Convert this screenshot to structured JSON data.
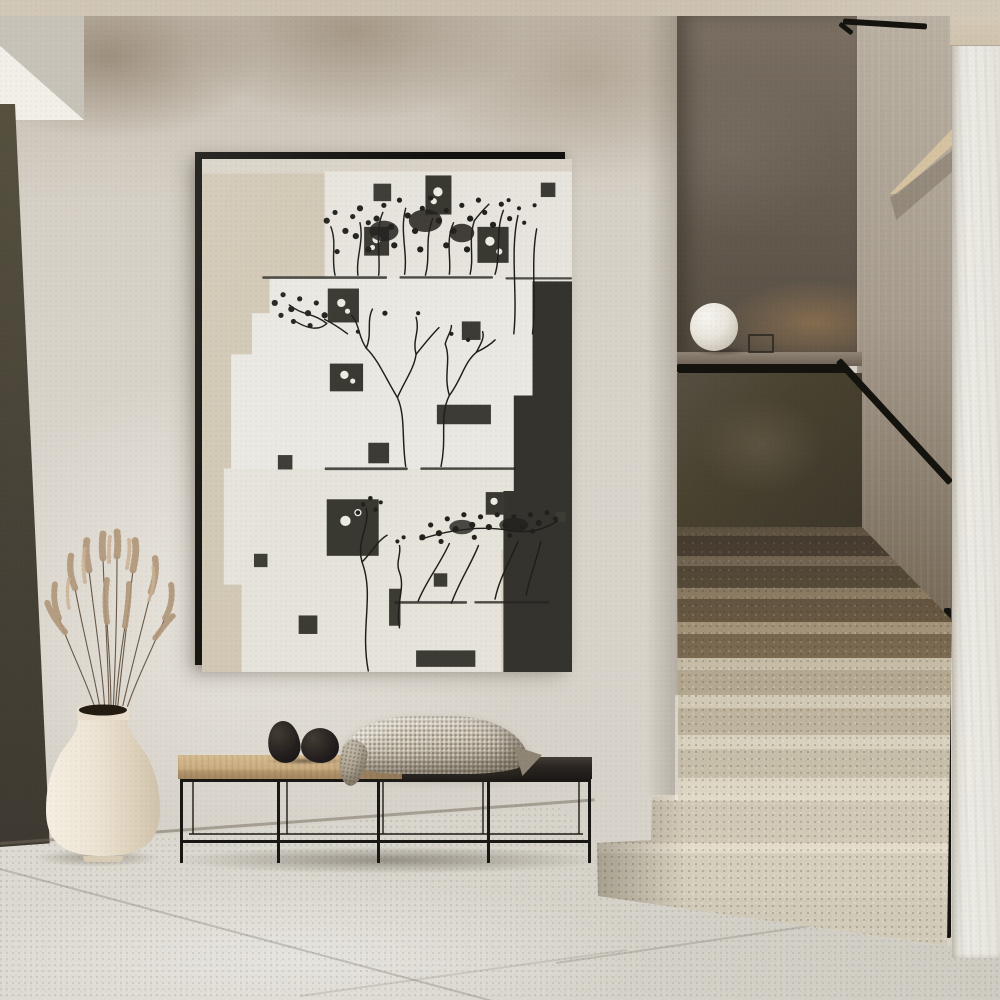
{
  "meta": {
    "title": "Minimalist hallway interior",
    "description": "Photorealistic render of a hallway with a framed black-and-white botanical collage above a slim metal bench, a cream vase with dried grass, and a terrazzo staircase with black handrail and sphere lamp"
  },
  "scene": {
    "artwork": {
      "label": "Framed botanical collage print",
      "frame_color": "#12110e",
      "canvas_base": "#d8d1c2",
      "paper_blocks": [
        "#eae8e2",
        "#e7e4dd",
        "#d1c7b4"
      ],
      "dark_block": "#34332d",
      "branch_color": "#201e1a",
      "photo_square": "#3a3931",
      "bloom_color": "#edebe3"
    },
    "bench": {
      "label": "Slim black metal bench with oak and black top",
      "wood_top": "#ccae82",
      "dark_top": "#2a2521",
      "frame_color": "#1a1815",
      "decor_stones": "two matte black stone spheres",
      "stone_color": "#262120",
      "throw_label": "Waffle knit throw blanket",
      "throw_color": "#c6bdac"
    },
    "vase": {
      "label": "Cream ceramic vase with dried grass plumes",
      "body_color": "#ece3d2",
      "mouth_color": "#241b11",
      "grass_color": "#b1977a"
    },
    "staircase": {
      "label": "Terrazzo staircase with black handrail",
      "handrail_color": "#15130e",
      "upper_wall": "#695f53",
      "half_wall": "#48412f",
      "upper_steps": "#8a7a63",
      "lower_steps": "#ded7c5",
      "lamp_label": "Sphere table lamp on landing ledge",
      "lamp_color": "#f7f5f0"
    },
    "room": {
      "ceiling_color": "#cfc5b4",
      "wall_color": "#d7d2c9",
      "wall_blotch_color": "#9b8c79",
      "floor_color": "#d7d4cb",
      "grout_color": "#6e6960",
      "left_door_color": "#4a4539",
      "right_column_color": "#e9e7e1",
      "floor_label": "Large-format stone tile floor",
      "wall_label": "Lime plaster wall",
      "door_label": "Dark door reveal at left edge",
      "column_label": "White plaster column"
    }
  }
}
